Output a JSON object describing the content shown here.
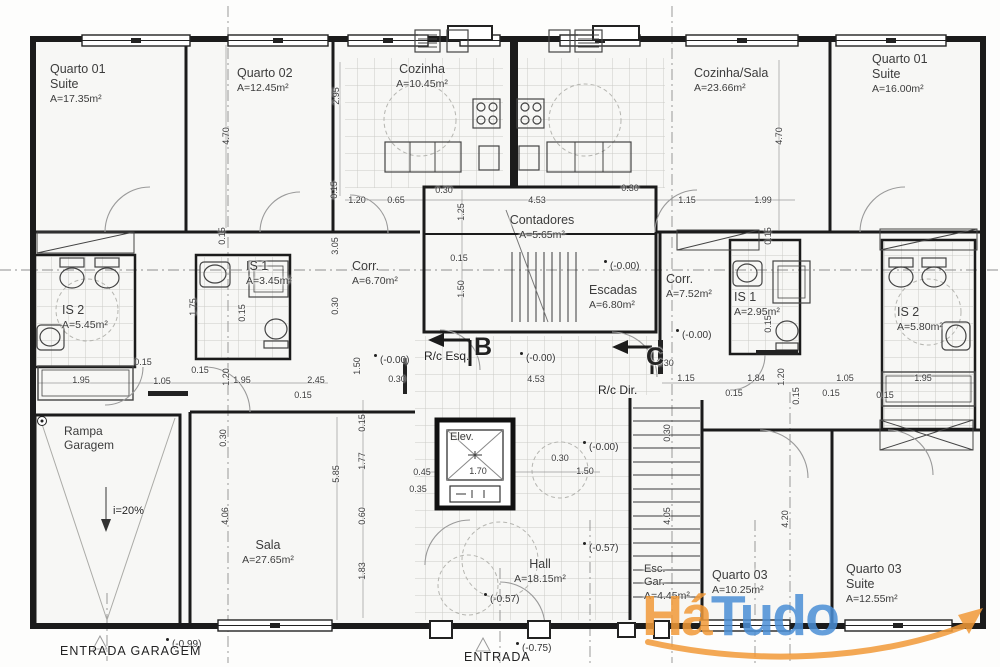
{
  "logo": {
    "text1": "Há",
    "text2": "Tudo",
    "color1": "#F29A38",
    "color2": "#4B8FD6"
  },
  "rooms": [
    {
      "name": "Quarto 01\nSuite",
      "area": "A=17.35m²",
      "x": 50,
      "y": 62
    },
    {
      "name": "Quarto 02",
      "area": "A=12.45m²",
      "x": 237,
      "y": 66
    },
    {
      "name": "Cozinha",
      "area": "A=10.45m²",
      "x": 422,
      "y": 62,
      "c": 1
    },
    {
      "name": "Cozinha/Sala",
      "area": "A=23.66m²",
      "x": 694,
      "y": 66
    },
    {
      "name": "Quarto 01\nSuite",
      "area": "A=16.00m²",
      "x": 872,
      "y": 52
    },
    {
      "name": "IS 2",
      "area": "A=5.45m²",
      "x": 62,
      "y": 303
    },
    {
      "name": "IS 1",
      "area": "A=3.45m²",
      "x": 246,
      "y": 259
    },
    {
      "name": "Corr.",
      "area": "A=6.70m²",
      "x": 352,
      "y": 259
    },
    {
      "name": "Contadores",
      "area": "A=5.65m²",
      "x": 542,
      "y": 213,
      "c": 1
    },
    {
      "name": "Escadas",
      "area": "A=6.80m²",
      "x": 589,
      "y": 283
    },
    {
      "name": "Corr.",
      "area": "A=7.52m²",
      "x": 666,
      "y": 272
    },
    {
      "name": "IS 1",
      "area": "A=2.95m²",
      "x": 734,
      "y": 290
    },
    {
      "name": "IS 2",
      "area": "A=5.80m²",
      "x": 897,
      "y": 305
    },
    {
      "name": "Rampa\nGaragem",
      "area": "",
      "x": 64,
      "y": 424,
      "s": 12
    },
    {
      "name": "Sala",
      "area": "A=27.65m²",
      "x": 268,
      "y": 538,
      "c": 1
    },
    {
      "name": "Elev.",
      "area": "",
      "x": 450,
      "y": 431,
      "s": 11
    },
    {
      "name": "Hall",
      "area": "A=18.15m²",
      "x": 540,
      "y": 557,
      "c": 1
    },
    {
      "name": "Esc.\nGar.",
      "area": "A=4.45m²",
      "x": 644,
      "y": 563,
      "s": 11
    },
    {
      "name": "Quarto 03",
      "area": "A=10.25m²",
      "x": 712,
      "y": 568
    },
    {
      "name": "Quarto 03\nSuite",
      "area": "A=12.55m²",
      "x": 846,
      "y": 562
    }
  ],
  "annotations": [
    {
      "t": "R/c Esq.",
      "x": 424,
      "y": 349,
      "s": 12
    },
    {
      "t": "B",
      "x": 474,
      "y": 333,
      "s": 25,
      "b": 1
    },
    {
      "t": "R/c Dir.",
      "x": 598,
      "y": 383,
      "s": 12
    },
    {
      "t": "C",
      "x": 646,
      "y": 343,
      "s": 25,
      "b": 1
    },
    {
      "t": "i=20%",
      "x": 113,
      "y": 505,
      "s": 11
    },
    {
      "t": "ENTRADA GARAGEM",
      "x": 60,
      "y": 644,
      "s": 12.5,
      "sp": 1
    },
    {
      "t": "ENTRADA",
      "x": 464,
      "y": 650,
      "s": 12.5,
      "sp": 1
    }
  ],
  "elevations": [
    {
      "t": "(-0.00)",
      "x": 604,
      "y": 260
    },
    {
      "t": "(-0.00)",
      "x": 374,
      "y": 354
    },
    {
      "t": "(-0.00)",
      "x": 520,
      "y": 352
    },
    {
      "t": "(-0.00)",
      "x": 676,
      "y": 329
    },
    {
      "t": "(-0.00)",
      "x": 583,
      "y": 441
    },
    {
      "t": "(-0.57)",
      "x": 583,
      "y": 542
    },
    {
      "t": "(-0.57)",
      "x": 484,
      "y": 593
    },
    {
      "t": "(-0.75)",
      "x": 516,
      "y": 642
    },
    {
      "t": "(-0.99)",
      "x": 166,
      "y": 638
    }
  ],
  "dimensions": [
    {
      "t": "2.95",
      "x": 336,
      "y": 96,
      "v": 1
    },
    {
      "t": "4.70",
      "x": 226,
      "y": 136,
      "v": 1
    },
    {
      "t": "4.70",
      "x": 779,
      "y": 136,
      "v": 1
    },
    {
      "t": "0.15",
      "x": 334,
      "y": 190,
      "v": 1
    },
    {
      "t": "1.20",
      "x": 357,
      "y": 200
    },
    {
      "t": "0.65",
      "x": 396,
      "y": 200
    },
    {
      "t": "0.30",
      "x": 444,
      "y": 190
    },
    {
      "t": "4.53",
      "x": 537,
      "y": 200
    },
    {
      "t": "0.30",
      "x": 630,
      "y": 188
    },
    {
      "t": "1.15",
      "x": 687,
      "y": 200
    },
    {
      "t": "1.99",
      "x": 763,
      "y": 200
    },
    {
      "t": "1.25",
      "x": 461,
      "y": 212,
      "v": 1
    },
    {
      "t": "0.15",
      "x": 459,
      "y": 258
    },
    {
      "t": "1.50",
      "x": 461,
      "y": 289,
      "v": 1
    },
    {
      "t": "3.05",
      "x": 335,
      "y": 246,
      "v": 1
    },
    {
      "t": "0.30",
      "x": 335,
      "y": 306,
      "v": 1
    },
    {
      "t": "0.15",
      "x": 222,
      "y": 236,
      "v": 1
    },
    {
      "t": "1.75",
      "x": 193,
      "y": 307,
      "v": 1
    },
    {
      "t": "0.15",
      "x": 242,
      "y": 313,
      "v": 1
    },
    {
      "t": "0.15",
      "x": 768,
      "y": 236,
      "v": 1
    },
    {
      "t": "0.15",
      "x": 768,
      "y": 324,
      "v": 1
    },
    {
      "t": "1.50",
      "x": 357,
      "y": 366,
      "v": 1
    },
    {
      "t": "0.30",
      "x": 397,
      "y": 379
    },
    {
      "t": "4.53",
      "x": 536,
      "y": 379
    },
    {
      "t": "0.30",
      "x": 665,
      "y": 363
    },
    {
      "t": "0.15",
      "x": 143,
      "y": 362
    },
    {
      "t": "1.95",
      "x": 81,
      "y": 380
    },
    {
      "t": "1.05",
      "x": 162,
      "y": 381
    },
    {
      "t": "0.15",
      "x": 200,
      "y": 370
    },
    {
      "t": "1.20",
      "x": 226,
      "y": 377,
      "v": 1
    },
    {
      "t": "1.95",
      "x": 242,
      "y": 380
    },
    {
      "t": "2.45",
      "x": 316,
      "y": 380
    },
    {
      "t": "0.15",
      "x": 303,
      "y": 395
    },
    {
      "t": "1.15",
      "x": 686,
      "y": 378
    },
    {
      "t": "1.84",
      "x": 756,
      "y": 378
    },
    {
      "t": "1.20",
      "x": 781,
      "y": 377,
      "v": 1
    },
    {
      "t": "1.05",
      "x": 845,
      "y": 378
    },
    {
      "t": "1.95",
      "x": 923,
      "y": 378
    },
    {
      "t": "0.15",
      "x": 734,
      "y": 393
    },
    {
      "t": "0.15",
      "x": 796,
      "y": 396,
      "v": 1
    },
    {
      "t": "0.15",
      "x": 831,
      "y": 393
    },
    {
      "t": "0.15",
      "x": 885,
      "y": 395
    },
    {
      "t": "0.30",
      "x": 223,
      "y": 438,
      "v": 1
    },
    {
      "t": "4.06",
      "x": 225,
      "y": 516,
      "v": 1
    },
    {
      "t": "5.85",
      "x": 336,
      "y": 474,
      "v": 1
    },
    {
      "t": "0.15",
      "x": 362,
      "y": 423,
      "v": 1
    },
    {
      "t": "1.77",
      "x": 362,
      "y": 461,
      "v": 1
    },
    {
      "t": "0.60",
      "x": 362,
      "y": 516,
      "v": 1
    },
    {
      "t": "1.83",
      "x": 362,
      "y": 571,
      "v": 1
    },
    {
      "t": "0.45",
      "x": 422,
      "y": 472
    },
    {
      "t": "0.35",
      "x": 418,
      "y": 489
    },
    {
      "t": "1.70",
      "x": 478,
      "y": 471
    },
    {
      "t": "0.30",
      "x": 560,
      "y": 458
    },
    {
      "t": "1.50",
      "x": 585,
      "y": 471
    },
    {
      "t": "0.30",
      "x": 667,
      "y": 433,
      "v": 1
    },
    {
      "t": "4.05",
      "x": 667,
      "y": 516,
      "v": 1
    },
    {
      "t": "4.20",
      "x": 785,
      "y": 519,
      "v": 1
    }
  ]
}
